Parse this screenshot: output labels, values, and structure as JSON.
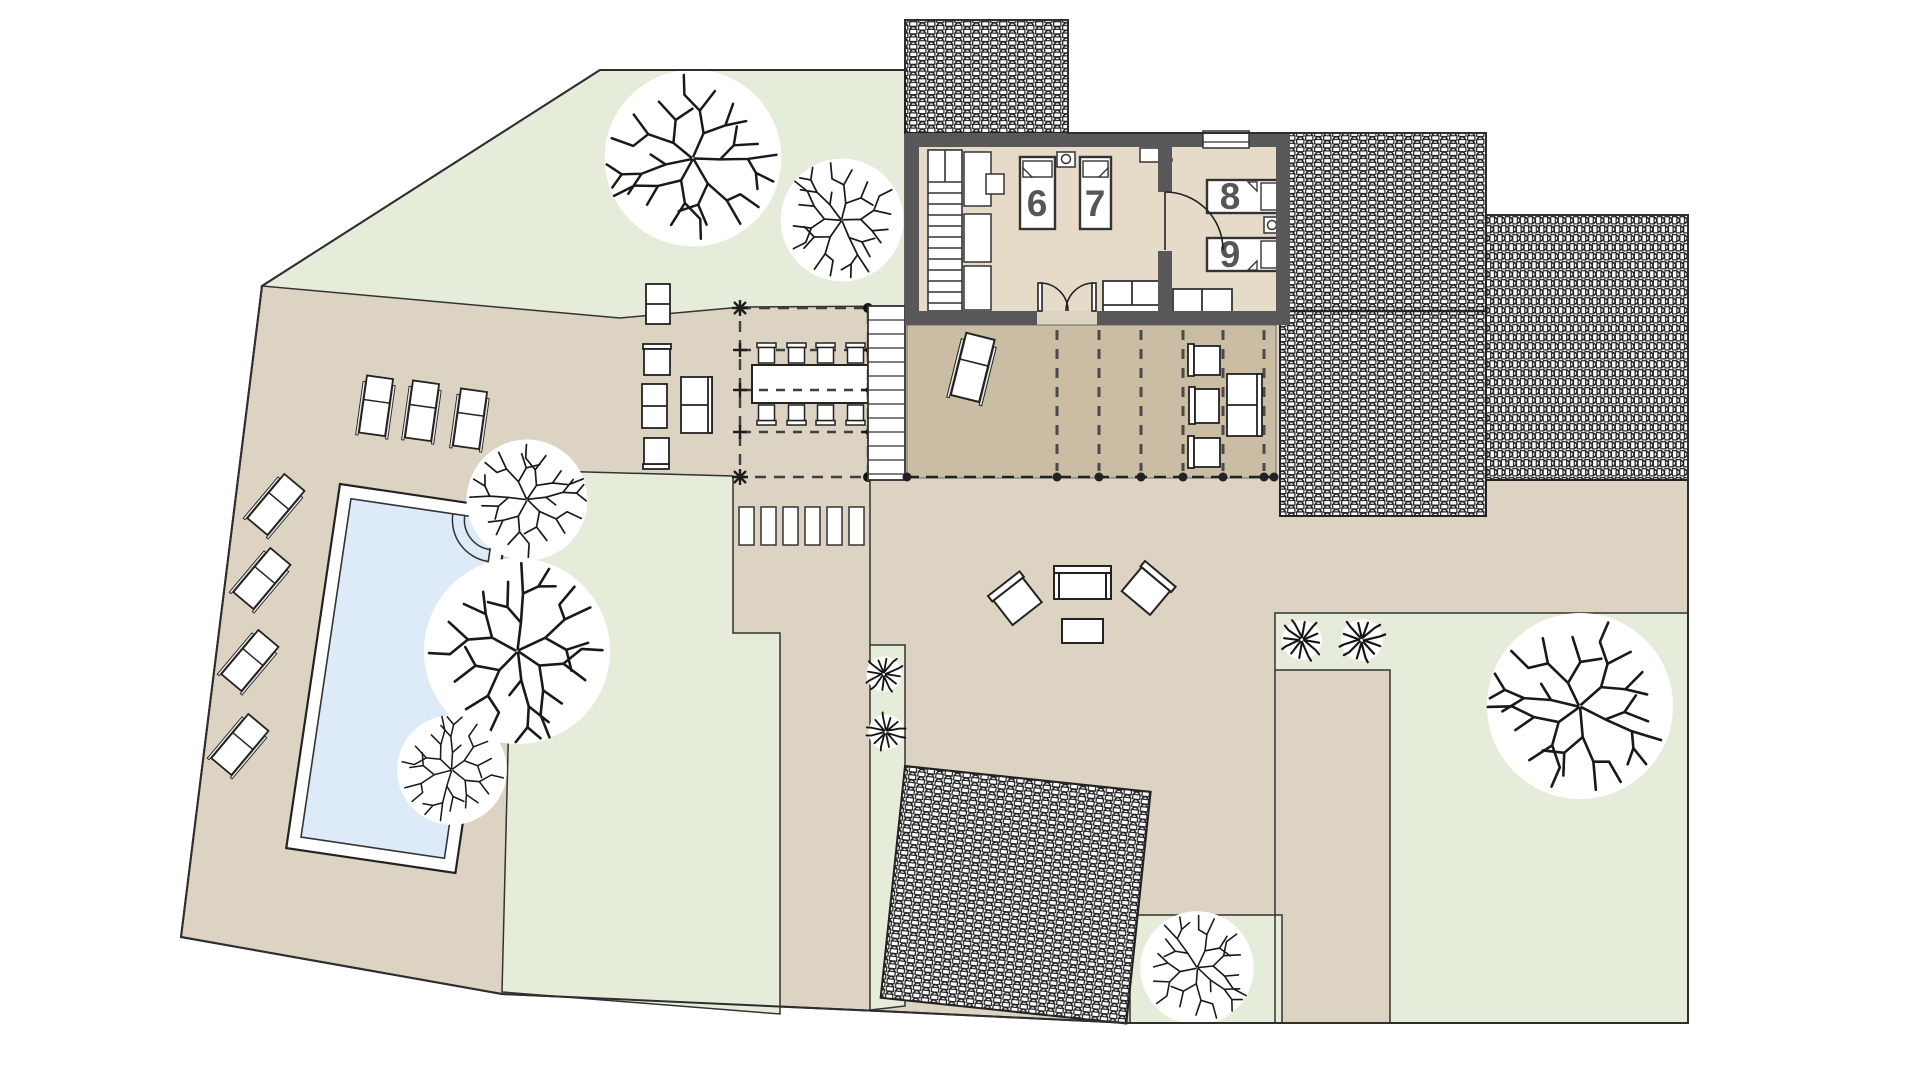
{
  "title": "Villa site and floor plan",
  "rooms": {
    "bed6": "6",
    "bed7": "7",
    "bed8": "8",
    "bed9": "9"
  },
  "colors": {
    "background": "#ffffff",
    "ground": "#dcd3c3",
    "grass": "#e6ecda",
    "building_interior": "#e6dbc9",
    "covered_terrace": "#cbbda4",
    "wall": "#58585a",
    "pool_water": "#dcebf7",
    "outline": "#2e2e2e",
    "room_label": "#55555a"
  }
}
